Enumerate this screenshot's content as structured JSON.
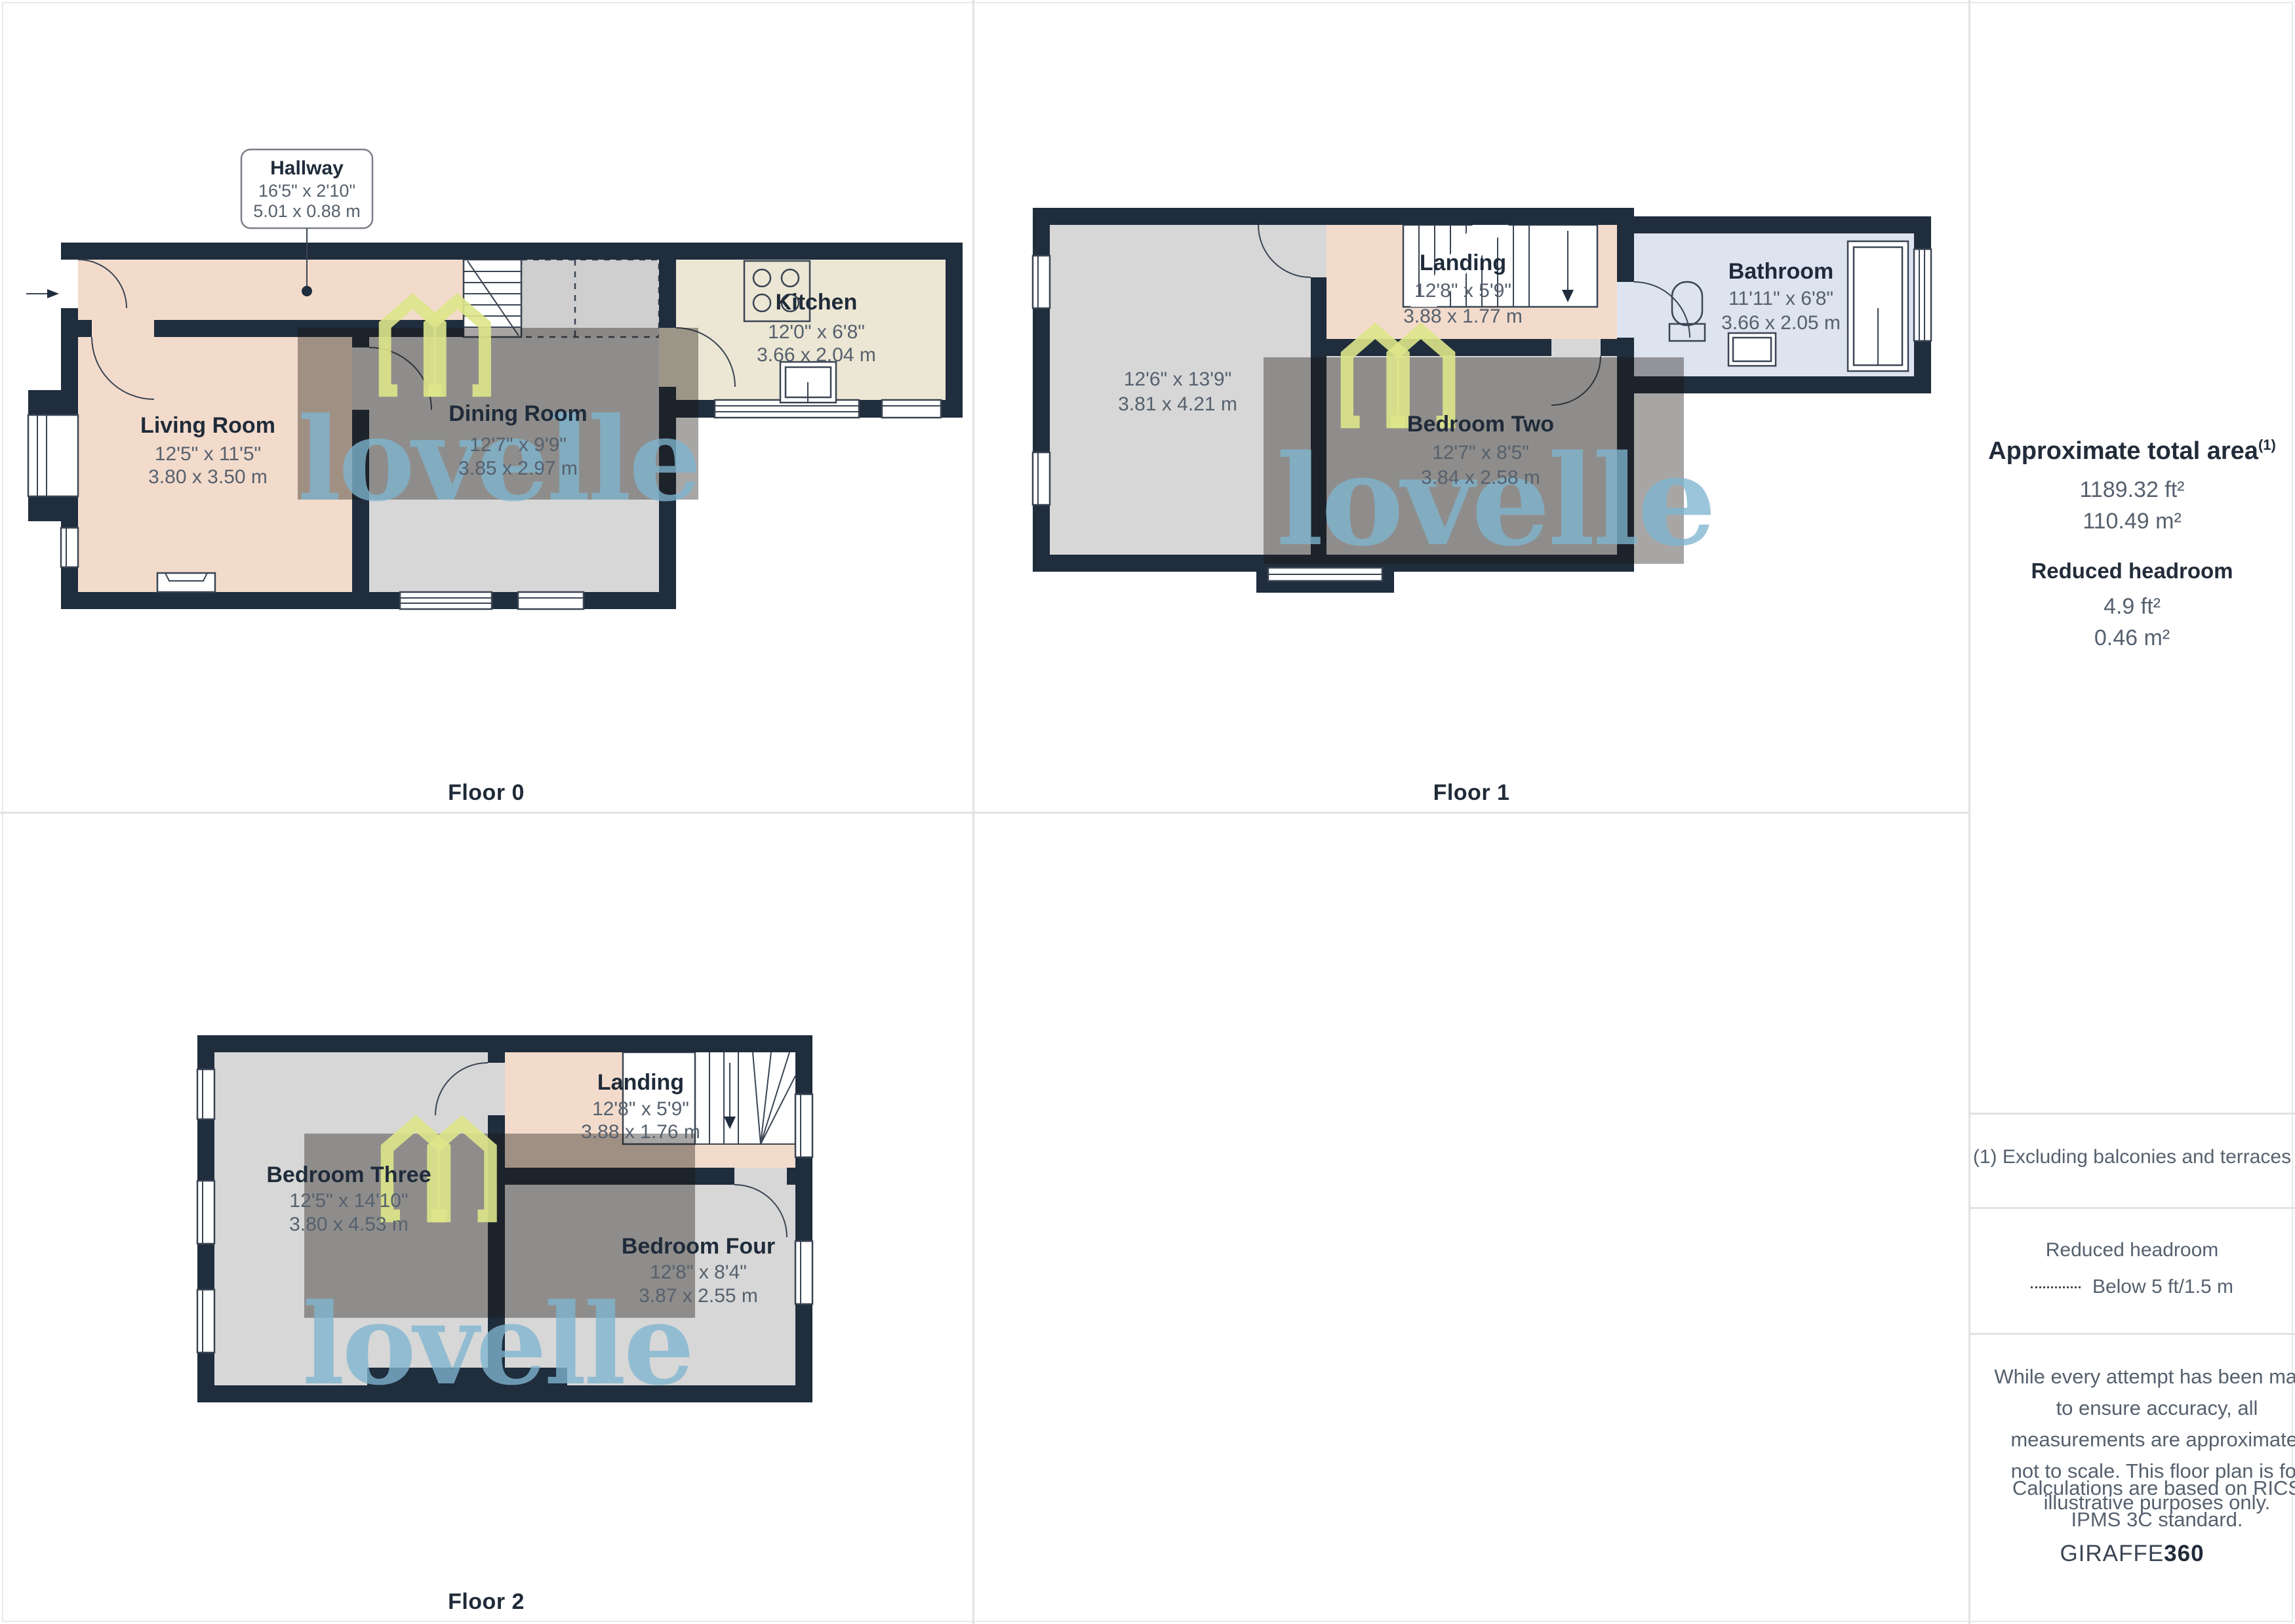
{
  "brand": {
    "watermark_text": "lovelle",
    "giraffe": "GIRAFFE",
    "giraffe_suffix": "360"
  },
  "colors": {
    "wall": "#1f2d3d",
    "hall_landing_fill": "#f3dbcc",
    "room_grey_fill": "#d7d7d7",
    "kitchen_fill": "#ece6d4",
    "bathroom_fill": "#dde3ef",
    "watermark_overlay": "rgba(25,20,15,0.38)",
    "logo_green": "#dde58a",
    "watermark_blue": "#7fb5d0"
  },
  "floors": {
    "floor0": {
      "label": "Floor 0",
      "rooms": {
        "hallway": {
          "name": "Hallway",
          "dims_ft": "16'5\" x 2'10\"",
          "dims_m": "5.01 x 0.88 m"
        },
        "living_room": {
          "name": "Living Room",
          "dims_ft": "12'5\" x 11'5\"",
          "dims_m": "3.80 x 3.50 m"
        },
        "dining_room": {
          "name": "Dining Room",
          "dims_ft": "12'7\" x 9'9\"",
          "dims_m": "3.85 x 2.97 m"
        },
        "kitchen": {
          "name": "Kitchen",
          "dims_ft": "12'0\" x 6'8\"",
          "dims_m": "3.66 x 2.04 m"
        }
      }
    },
    "floor1": {
      "label": "Floor 1",
      "rooms": {
        "bedroom_one": {
          "dims_ft": "12'6\" x 13'9\"",
          "dims_m": "3.81 x 4.21 m"
        },
        "landing": {
          "name": "Landing",
          "dims_ft": "12'8\" x 5'9\"",
          "dims_m": "3.88 x 1.77 m"
        },
        "bedroom_two": {
          "name": "Bedroom Two",
          "dims_ft": "12'7\" x 8'5\"",
          "dims_m": "3.84 x 2.58 m"
        },
        "bathroom": {
          "name": "Bathroom",
          "dims_ft": "11'11\" x 6'8\"",
          "dims_m": "3.66 x 2.05 m"
        }
      }
    },
    "floor2": {
      "label": "Floor 2",
      "rooms": {
        "bedroom_three": {
          "name": "Bedroom Three",
          "dims_ft": "12'5\" x 14'10\"",
          "dims_m": "3.80 x 4.53 m"
        },
        "landing": {
          "name": "Landing",
          "dims_ft": "12'8\" x 5'9\"",
          "dims_m": "3.88 x 1.76 m"
        },
        "bedroom_four": {
          "name": "Bedroom Four",
          "dims_ft": "12'8\" x 8'4\"",
          "dims_m": "3.87 x 2.55 m"
        }
      }
    }
  },
  "sidebar": {
    "total_area_title": "Approximate total area",
    "footnote_marker": "(1)",
    "total_area_ft": "1189.32 ft²",
    "total_area_m": "110.49 m²",
    "reduced_headroom_title": "Reduced headroom",
    "reduced_headroom_ft": "4.9 ft²",
    "reduced_headroom_m": "0.46 m²",
    "footnote": "(1) Excluding balconies and terraces",
    "legend_title": "Reduced headroom",
    "legend_item": "Below 5 ft/1.5 m",
    "disclaimer1": "While every attempt has been made to ensure accuracy, all measurements are approximate, not to scale. This floor plan is for illustrative purposes only.",
    "disclaimer2": "Calculations are based on RICS IPMS 3C standard."
  }
}
